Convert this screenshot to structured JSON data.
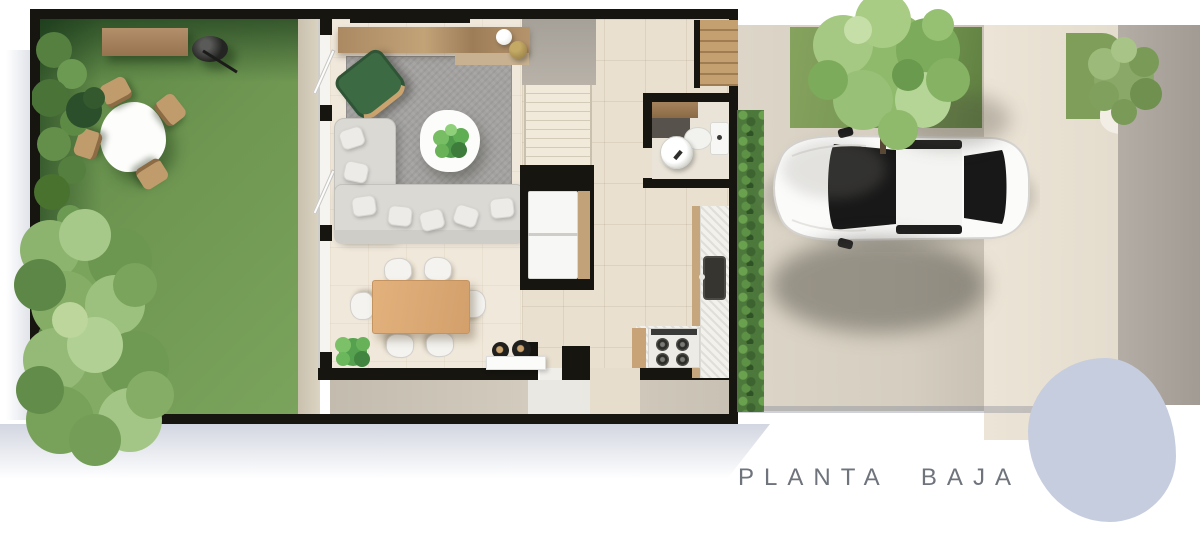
{
  "title": {
    "label": "PLANTA BAJA"
  },
  "palette": {
    "wall_black": "#16150f",
    "garden_grass": "#6c9150",
    "exterior_lawn": "#7f9e59",
    "interior_floor": "#efe7d9",
    "kitchen_tile": "#e9e0d0",
    "area_rug": "#a3a2a0",
    "wood_console": "#ab8a63",
    "wood_dining_table": "#dcab77",
    "sofa_gray": "#dbd9d4",
    "armchair_green": "#3c6a43",
    "driveway": "#d8d1c3",
    "sidewalk": "#e7dfd1",
    "street": "#aaa49c",
    "car_body": "#fafafa",
    "car_glass": "#191919",
    "paver_stone": "#c6cdde",
    "title_text": "#6e737c"
  },
  "plan": {
    "floor_label": "PLANTA BAJA",
    "areas": [
      "garden",
      "living-room",
      "dining-room",
      "kitchen",
      "bathroom",
      "staircase",
      "laundry-nook",
      "entry",
      "patio",
      "driveway",
      "sidewalk",
      "street"
    ],
    "objects": {
      "garden": [
        "garden-bench",
        "bbq-grill",
        "outdoor-table",
        "outdoor-chairs",
        "hedge-row",
        "garden-trees"
      ],
      "living_room": [
        "tv-console",
        "pendant-lamps",
        "green-armchair",
        "area-rug",
        "coffee-table",
        "potted-plant",
        "sectional-sofa",
        "throw-pillows"
      ],
      "dining_room": [
        "dining-table",
        "dining-chairs",
        "corner-plant",
        "bar-stools",
        "side-table"
      ],
      "kitchen": [
        "countertop",
        "kitchen-sink",
        "stove",
        "refrigerator-nook"
      ],
      "bathroom": [
        "toilet",
        "vessel-sink",
        "vanity-counter"
      ],
      "exterior": [
        "car",
        "driveway-tree",
        "lawn-patches",
        "street-shrub",
        "paver-stone"
      ]
    }
  }
}
